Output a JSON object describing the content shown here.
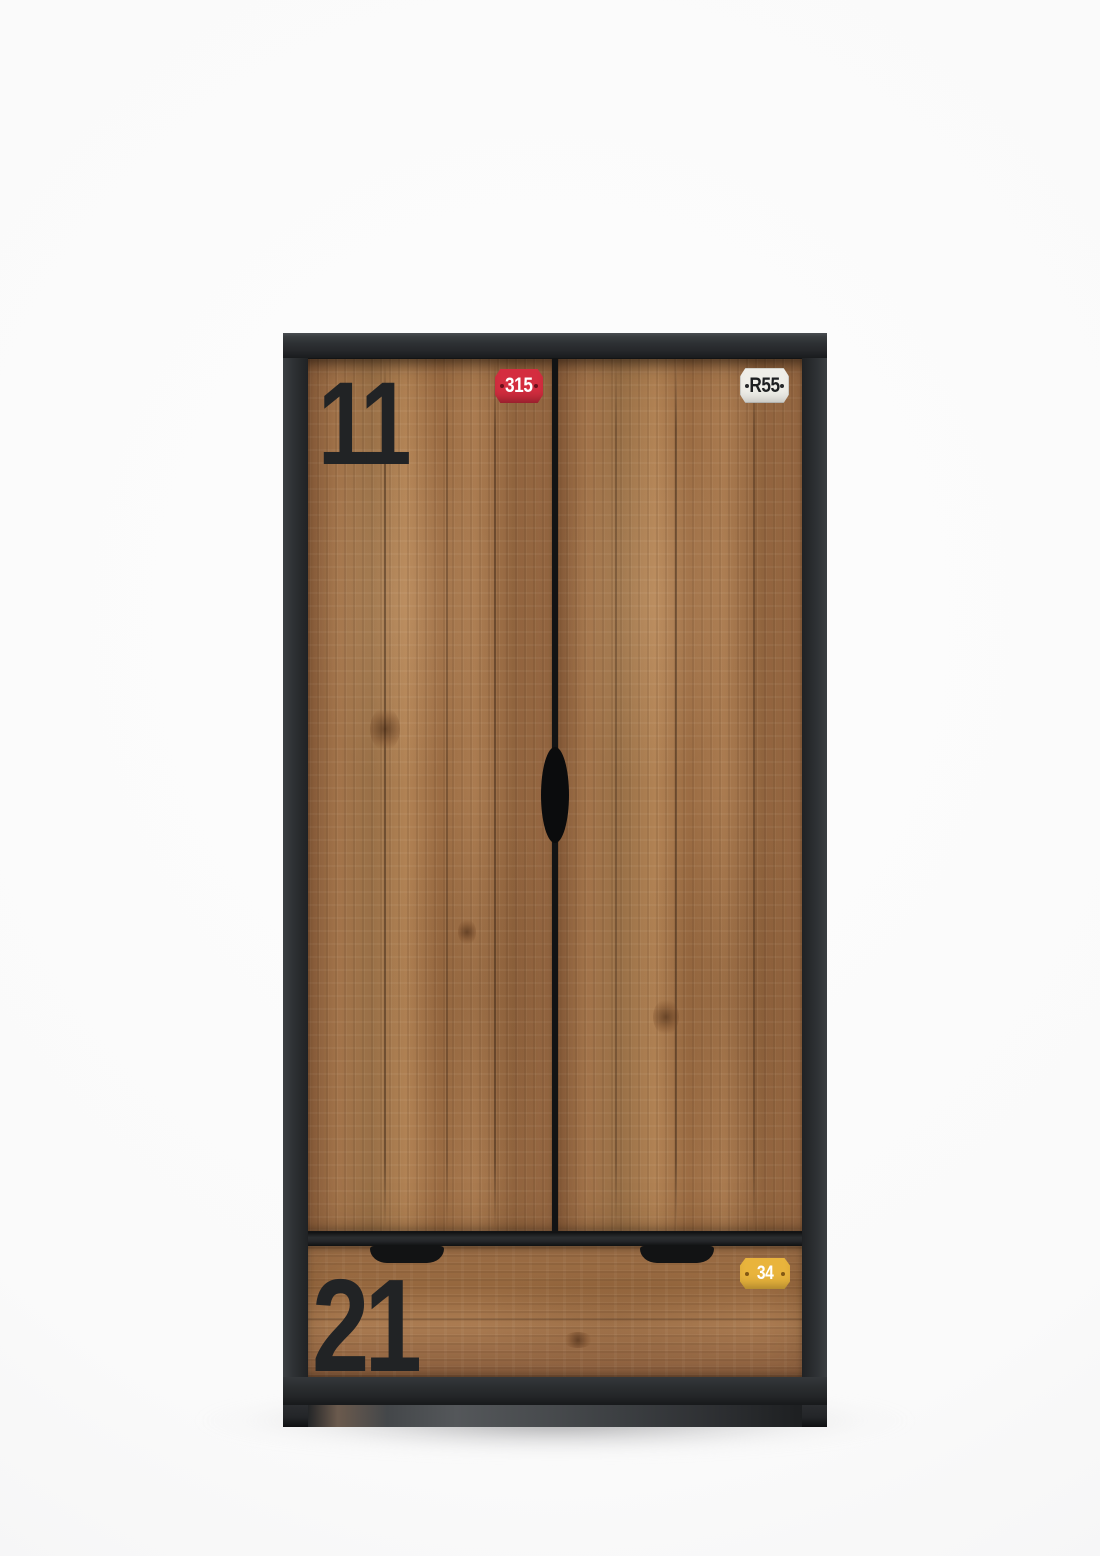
{
  "scene": {
    "type": "studio product photo",
    "subject": "industrial two-door wardrobe with bottom drawer, rough-sawn wood fronts in a black frame",
    "background_color": "#fbfbfb"
  },
  "wardrobe": {
    "frame_color": "#2d3033",
    "wood_color": "#a1724a",
    "left_door": {
      "stencil_number": "11",
      "badge": {
        "text": "315",
        "bg_color": "#d42d3f",
        "text_color": "#ffffff"
      }
    },
    "right_door": {
      "badge": {
        "text": "R55",
        "bg_color": "#efeee8",
        "text_color": "#1d1f21"
      }
    },
    "drawer": {
      "stencil_number": "21",
      "badge": {
        "text": "34",
        "bg_color": "#e9b43c",
        "text_color": "#ffffff"
      }
    }
  }
}
